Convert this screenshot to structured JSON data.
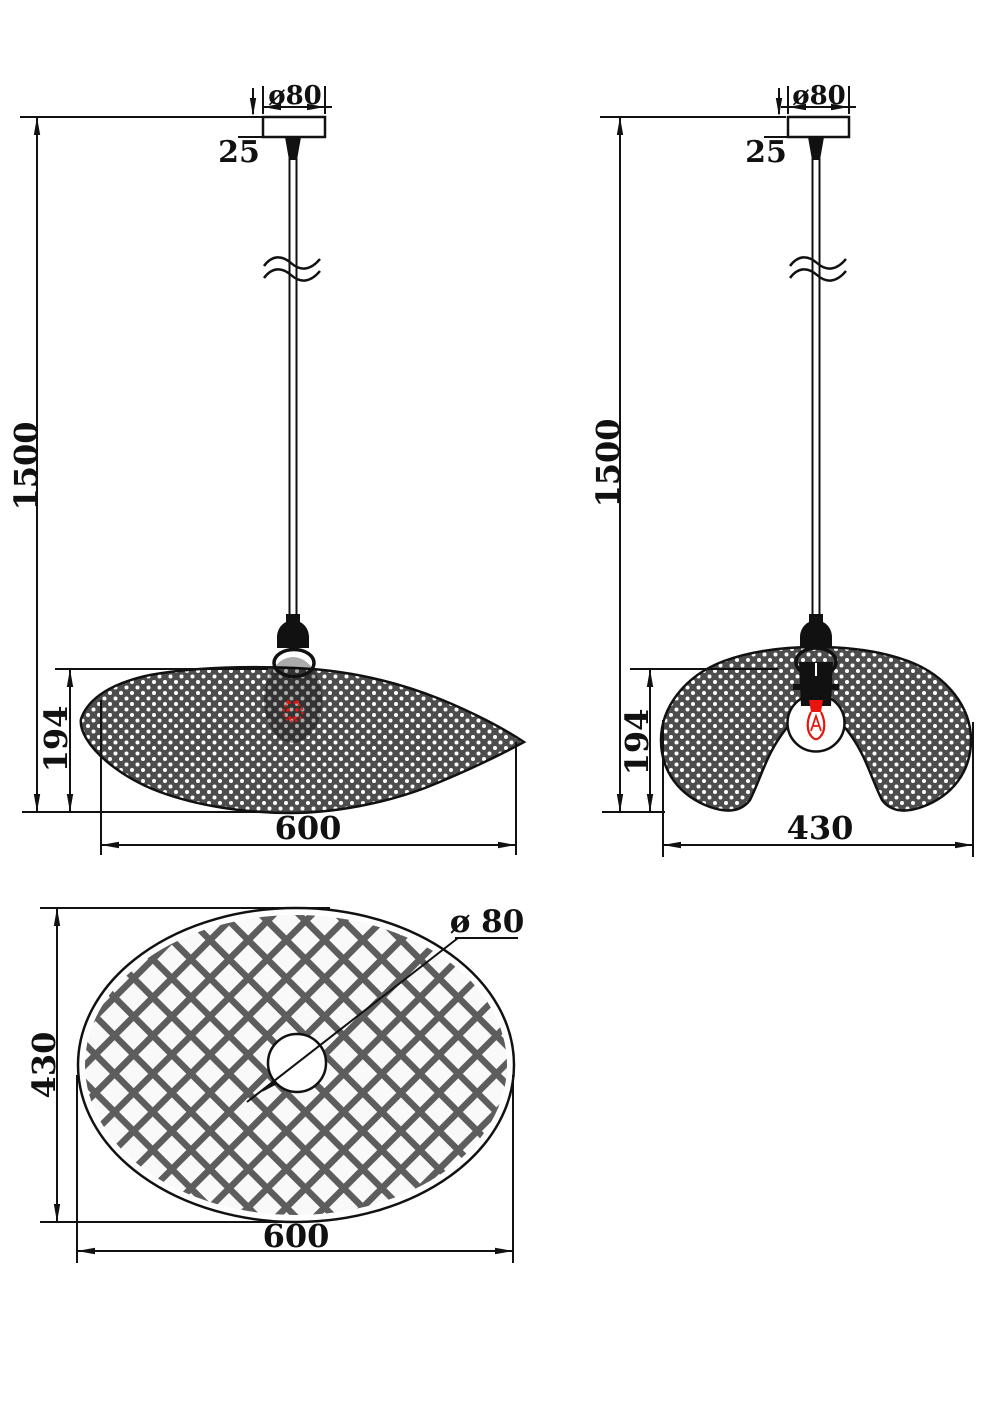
{
  "drawing": {
    "background": "#ffffff",
    "line_color": "#111111",
    "mesh_color": "#4d4d4d",
    "mesh_dot_color": "#ffffff",
    "lattice_color": "#5d5d5d",
    "filament_color": "#e8150e",
    "front_view": {
      "canopy_diameter": "ø80",
      "canopy_height": "25",
      "suspension_length": "1500",
      "shade_height": "194",
      "shade_width": "600"
    },
    "side_view": {
      "canopy_diameter": "ø80",
      "canopy_height": "25",
      "suspension_length": "1500",
      "shade_height": "194",
      "shade_width": "430"
    },
    "top_view": {
      "shade_width": "600",
      "shade_depth": "430",
      "hole_diameter": "ø 80"
    }
  }
}
